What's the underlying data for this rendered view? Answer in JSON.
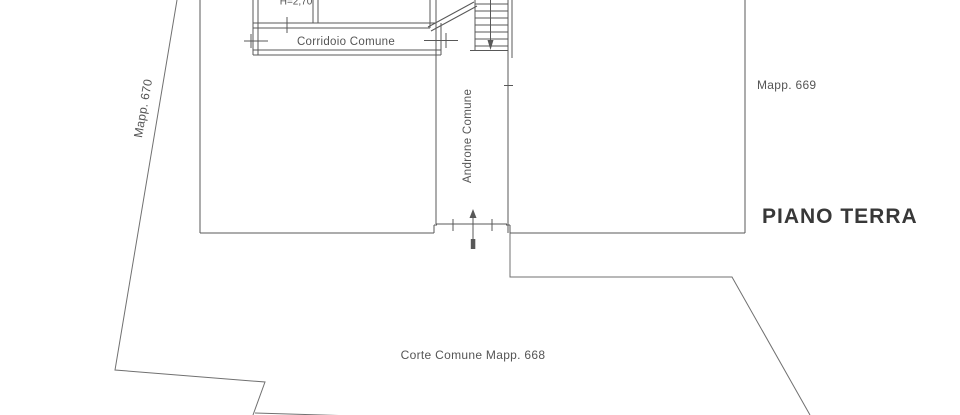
{
  "plan": {
    "title": "PIANO TERRA",
    "labels": {
      "corridor": "Corridoio Comune",
      "entrance_hall": "Androne Comune",
      "room_height": "H=2,70",
      "parcel_left": "Mapp. 670",
      "parcel_right": "Mapp. 669",
      "courtyard": "Corte Comune Mapp. 668"
    },
    "colors": {
      "boundary_line": "#707070",
      "wall_line": "#585858",
      "label_text": "#555555",
      "title_text": "#383838",
      "background": "#ffffff"
    }
  }
}
